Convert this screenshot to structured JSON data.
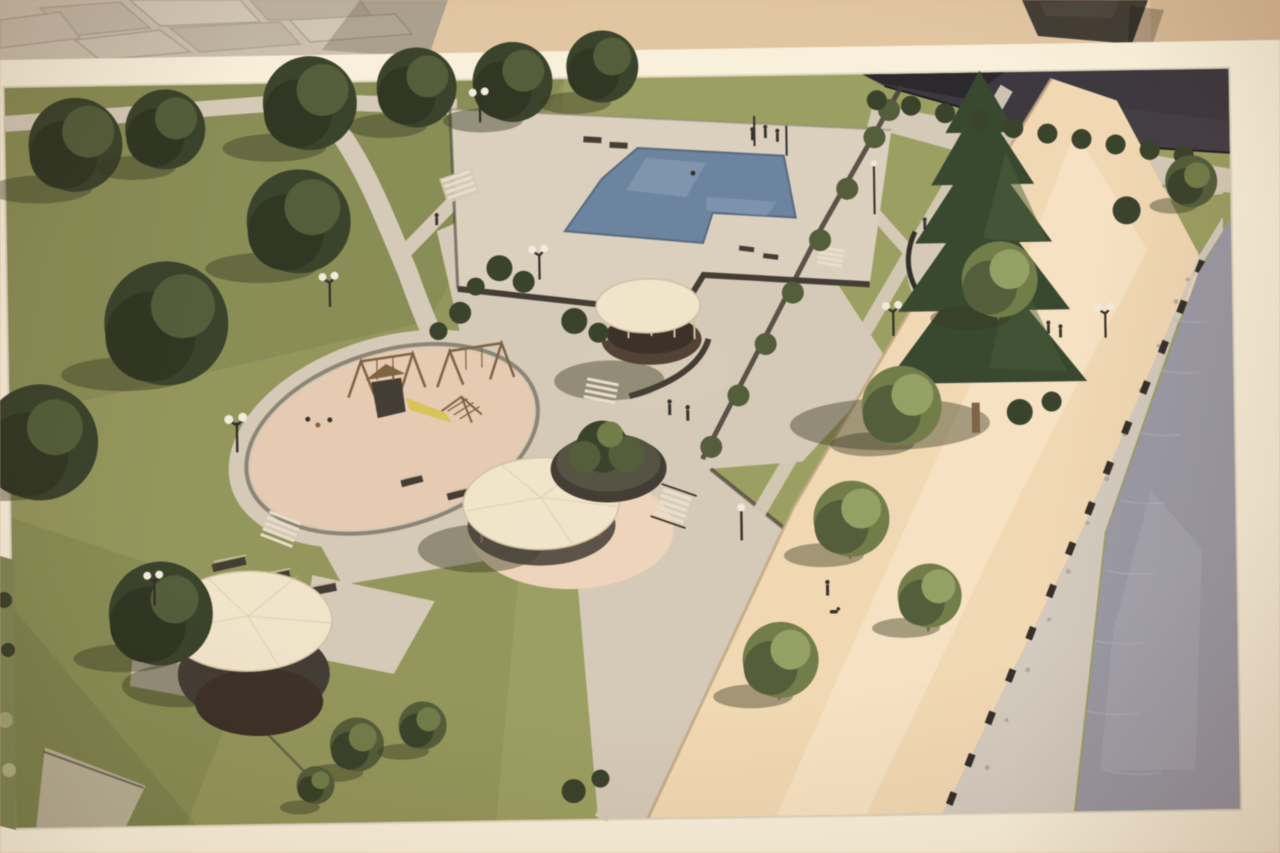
{
  "description": "Photograph of a printed architectural rendering: aerial view of a riverside park with an L-shaped swimming pool, three round-roofed gazebos, an oval playground, lawns with trees, a tall conifer, curved walkways, globe lamp posts, a sandy riverside promenade with a row of trees, a stone riprap embankment and a river; the print has a white border and lies on a tan surface beside other photographs.",
  "colors": {
    "bg_tan": "#d8b58f",
    "bg_tan_light": "#e9cfab",
    "bg_tan_dark": "#bd9770",
    "matte": "#f4edda",
    "matte_edge": "#d9d2bf",
    "pave": "#c6bcaa",
    "pave_dark": "#a59a87",
    "pave_shadow": "rgba(80,70,55,0.28)",
    "object_dark": "#3a342d",
    "photo_sliver": "#77834c",
    "grass": "#8b914f",
    "grass_light": "#b9bf6e",
    "grass_dark": "#5d6935",
    "tree": "#49562f",
    "tree_dark": "#2e3a21",
    "tree_deep": "#232d18",
    "tree_light": "#68773d",
    "tree_xlight": "#8b9c58",
    "conifer": "#2b4026",
    "conifer_light": "#41592f",
    "path": "#d0c6b4",
    "path_light": "#e3dac8",
    "deck": "#d5cbbb",
    "wall": "#3a332c",
    "pool": "#5f7da3",
    "pool_light": "#8aa6c2",
    "pg_pink": "#e4c5ad",
    "pad_pink": "#ead0b6",
    "roof": "#ece0c7",
    "roof_shade": "#cdbd9e",
    "sand": "#eed4ae",
    "sand_light": "#f6e5c6",
    "sand_edge": "#bb9f78",
    "rip": "#cdc7bd",
    "rip_dark": "#8f897e",
    "water": "#9194a7",
    "water_light": "#adb0c0",
    "posts": "#2a2521",
    "bld": "#332e39",
    "bld_dark": "#201c26",
    "lamp": "#ece8dc",
    "fig": "#2d2824",
    "slide": "#d7c143",
    "wood": "#7b5a37",
    "gz_base": "#4a392d",
    "gz_base_dark": "#33271f",
    "shadow": "rgba(42,48,22,0.42)"
  },
  "scene": {
    "setting": "aerial 3D rendering of a landscaped riverside park",
    "features": [
      "L-shaped swimming pool on paved deck",
      "central round gazebo with cream roof",
      "large gazebo on round pad with raised planter",
      "lower gazebo on lawn",
      "oval playground with swings, slide tower, climbing frame and benches",
      "tall conifer with circular path and curved benches",
      "curved park walkways and stairs",
      "double-globe lamp posts",
      "sandy riverside promenade with row of trees",
      "stone riprap embankment with bollards",
      "river",
      "dense tree cluster on lawns",
      "dark building at top edge",
      "pedestrians, swimmer, person walking a dog"
    ]
  },
  "photo_surroundings": [
    "stone pavement photo fragment at top-left",
    "dark object at top-right",
    "white matte border around print",
    "green photo sliver at lower-left edge"
  ]
}
